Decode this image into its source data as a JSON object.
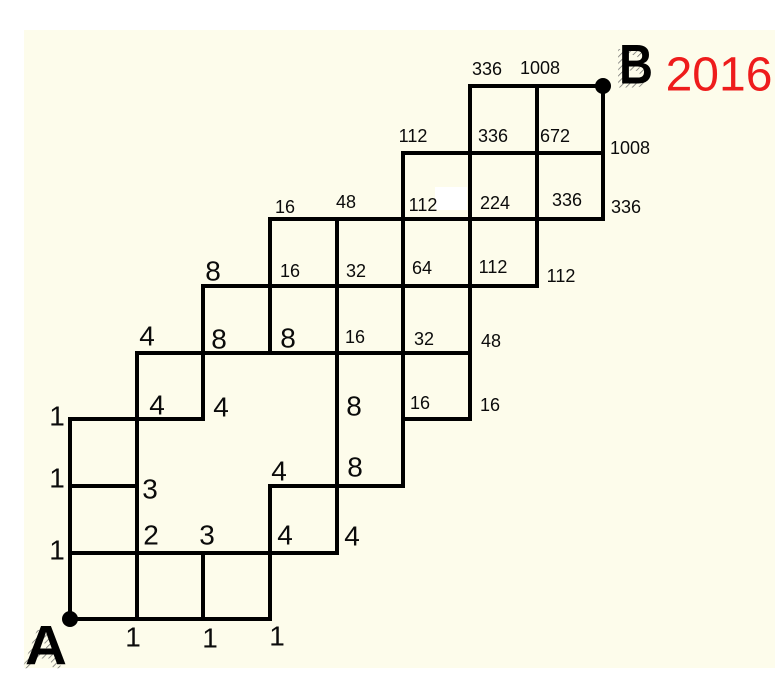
{
  "diagram_type": "lattice-path-counting",
  "colors": {
    "page_bg": "#ffffff",
    "canvas_bg": "#fdfceb",
    "line": "#000000",
    "label": "#0b0b0b",
    "total_red": "#ee1c1c"
  },
  "canvas": {
    "x": 24,
    "y": 30,
    "width": 751,
    "height": 638
  },
  "stroke_width": 4,
  "dot_radius": 8,
  "endpoints": {
    "start": {
      "letter": "A",
      "dot_x": 70,
      "dot_y": 619
    },
    "end": {
      "letter": "B",
      "dot_x": 603,
      "dot_y": 86
    },
    "total": {
      "value": "2016"
    }
  },
  "segments": {
    "horizontal": [
      [
        70,
        270,
        619
      ],
      [
        70,
        337,
        553
      ],
      [
        70,
        137,
        486
      ],
      [
        270,
        403,
        486
      ],
      [
        70,
        203,
        419
      ],
      [
        403,
        470,
        419
      ],
      [
        137,
        470,
        353
      ],
      [
        203,
        537,
        286
      ],
      [
        270,
        603,
        219
      ],
      [
        403,
        603,
        153
      ],
      [
        470,
        603,
        86
      ]
    ],
    "vertical": [
      [
        70,
        419,
        619
      ],
      [
        137,
        353,
        619
      ],
      [
        203,
        286,
        419
      ],
      [
        203,
        553,
        619
      ],
      [
        270,
        219,
        353
      ],
      [
        270,
        486,
        619
      ],
      [
        337,
        219,
        553
      ],
      [
        403,
        153,
        486
      ],
      [
        470,
        86,
        419
      ],
      [
        537,
        86,
        286
      ],
      [
        603,
        86,
        219
      ]
    ]
  },
  "white_patch": {
    "x": 435,
    "y": 187,
    "width": 32,
    "height": 23
  },
  "path_counts": [
    {
      "value": "1",
      "x": 133,
      "y": 637,
      "size": "lg"
    },
    {
      "value": "1",
      "x": 210,
      "y": 638,
      "size": "lg"
    },
    {
      "value": "1",
      "x": 277,
      "y": 636,
      "size": "lg"
    },
    {
      "value": "1",
      "x": 57,
      "y": 416,
      "size": "lg"
    },
    {
      "value": "1",
      "x": 57,
      "y": 478,
      "size": "lg"
    },
    {
      "value": "1",
      "x": 57,
      "y": 550,
      "size": "lg"
    },
    {
      "value": "2",
      "x": 151,
      "y": 535,
      "size": "lg"
    },
    {
      "value": "3",
      "x": 207,
      "y": 535,
      "size": "lg"
    },
    {
      "value": "4",
      "x": 285,
      "y": 535,
      "size": "lg"
    },
    {
      "value": "4",
      "x": 352,
      "y": 536,
      "size": "lg"
    },
    {
      "value": "3",
      "x": 150,
      "y": 489,
      "size": "lg"
    },
    {
      "value": "4",
      "x": 279,
      "y": 471,
      "size": "lg"
    },
    {
      "value": "8",
      "x": 355,
      "y": 467,
      "size": "lg"
    },
    {
      "value": "4",
      "x": 157,
      "y": 405,
      "size": "lg"
    },
    {
      "value": "4",
      "x": 221,
      "y": 407,
      "size": "lg"
    },
    {
      "value": "8",
      "x": 354,
      "y": 406,
      "size": "lg"
    },
    {
      "value": "16",
      "x": 420,
      "y": 403,
      "size": "sm"
    },
    {
      "value": "16",
      "x": 490,
      "y": 405,
      "size": "sm"
    },
    {
      "value": "4",
      "x": 147,
      "y": 336,
      "size": "lg"
    },
    {
      "value": "8",
      "x": 219,
      "y": 339,
      "size": "lg"
    },
    {
      "value": "8",
      "x": 288,
      "y": 338,
      "size": "lg"
    },
    {
      "value": "16",
      "x": 355,
      "y": 337,
      "size": "sm"
    },
    {
      "value": "32",
      "x": 424,
      "y": 339,
      "size": "sm"
    },
    {
      "value": "48",
      "x": 491,
      "y": 341,
      "size": "sm"
    },
    {
      "value": "8",
      "x": 213,
      "y": 271,
      "size": "lg"
    },
    {
      "value": "16",
      "x": 290,
      "y": 271,
      "size": "sm"
    },
    {
      "value": "32",
      "x": 356,
      "y": 271,
      "size": "sm"
    },
    {
      "value": "64",
      "x": 422,
      "y": 268,
      "size": "sm"
    },
    {
      "value": "112",
      "x": 493,
      "y": 267,
      "size": "sm"
    },
    {
      "value": "112",
      "x": 561,
      "y": 276,
      "size": "sm"
    },
    {
      "value": "16",
      "x": 285,
      "y": 207,
      "size": "sm"
    },
    {
      "value": "48",
      "x": 346,
      "y": 202,
      "size": "sm"
    },
    {
      "value": "112",
      "x": 423,
      "y": 205,
      "size": "sm"
    },
    {
      "value": "224",
      "x": 495,
      "y": 203,
      "size": "sm"
    },
    {
      "value": "336",
      "x": 567,
      "y": 200,
      "size": "sm"
    },
    {
      "value": "336",
      "x": 626,
      "y": 207,
      "size": "sm"
    },
    {
      "value": "112",
      "x": 413,
      "y": 136,
      "size": "sm"
    },
    {
      "value": "336",
      "x": 493,
      "y": 136,
      "size": "sm"
    },
    {
      "value": "672",
      "x": 555,
      "y": 136,
      "size": "sm"
    },
    {
      "value": "1008",
      "x": 630,
      "y": 148,
      "size": "sm"
    },
    {
      "value": "336",
      "x": 487,
      "y": 69,
      "size": "sm"
    },
    {
      "value": "1008",
      "x": 540,
      "y": 68,
      "size": "sm"
    }
  ]
}
